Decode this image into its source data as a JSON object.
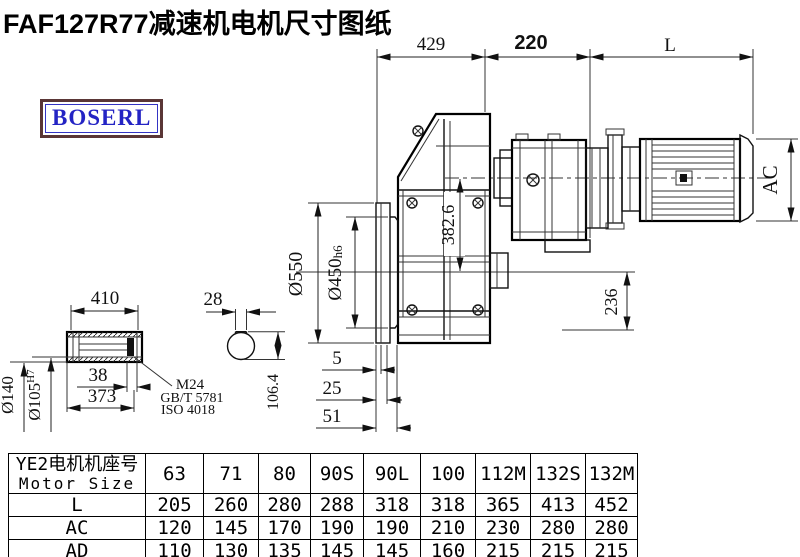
{
  "title": "FAF127R77减速机电机尺寸图纸",
  "logo": {
    "text": "BOSERL"
  },
  "colors": {
    "logo_border": "#5a3636",
    "logo_text": "#2424c4",
    "line": "#000000"
  },
  "drawing": {
    "dims": {
      "housing_width": "429",
      "adapter_length": "220",
      "motor_length": "L",
      "motor_diameter": "AC",
      "flange_od": "Ø550",
      "spigot_value": "Ø450",
      "spigot_tol": "h6",
      "center_distance": "382.6",
      "axis_height": "236",
      "offset_small": "5",
      "offset_mid": "25",
      "offset_large": "51",
      "shaft_length": "410",
      "keyway_width": "28",
      "plug_depth": "38",
      "bore_depth": "373",
      "shaft_od": "Ø140",
      "bore_value": "Ø105",
      "bore_tol": "H7",
      "keyway_height": "106.4",
      "bolt_spec": [
        "M24",
        "GB/T 5781",
        "ISO 4018"
      ]
    }
  },
  "table": {
    "header_cn": "YE2电机机座号",
    "header_en": "Motor Size",
    "columns": [
      "63",
      "71",
      "80",
      "90S",
      "90L",
      "100",
      "112M",
      "132S",
      "132M"
    ],
    "rows": [
      {
        "label": "L",
        "values": [
          "205",
          "260",
          "280",
          "288",
          "318",
          "318",
          "365",
          "413",
          "452"
        ]
      },
      {
        "label": "AC",
        "values": [
          "120",
          "145",
          "170",
          "190",
          "190",
          "210",
          "230",
          "280",
          "280"
        ]
      },
      {
        "label": "AD",
        "values": [
          "110",
          "130",
          "135",
          "145",
          "145",
          "160",
          "215",
          "215",
          "215"
        ]
      }
    ]
  }
}
